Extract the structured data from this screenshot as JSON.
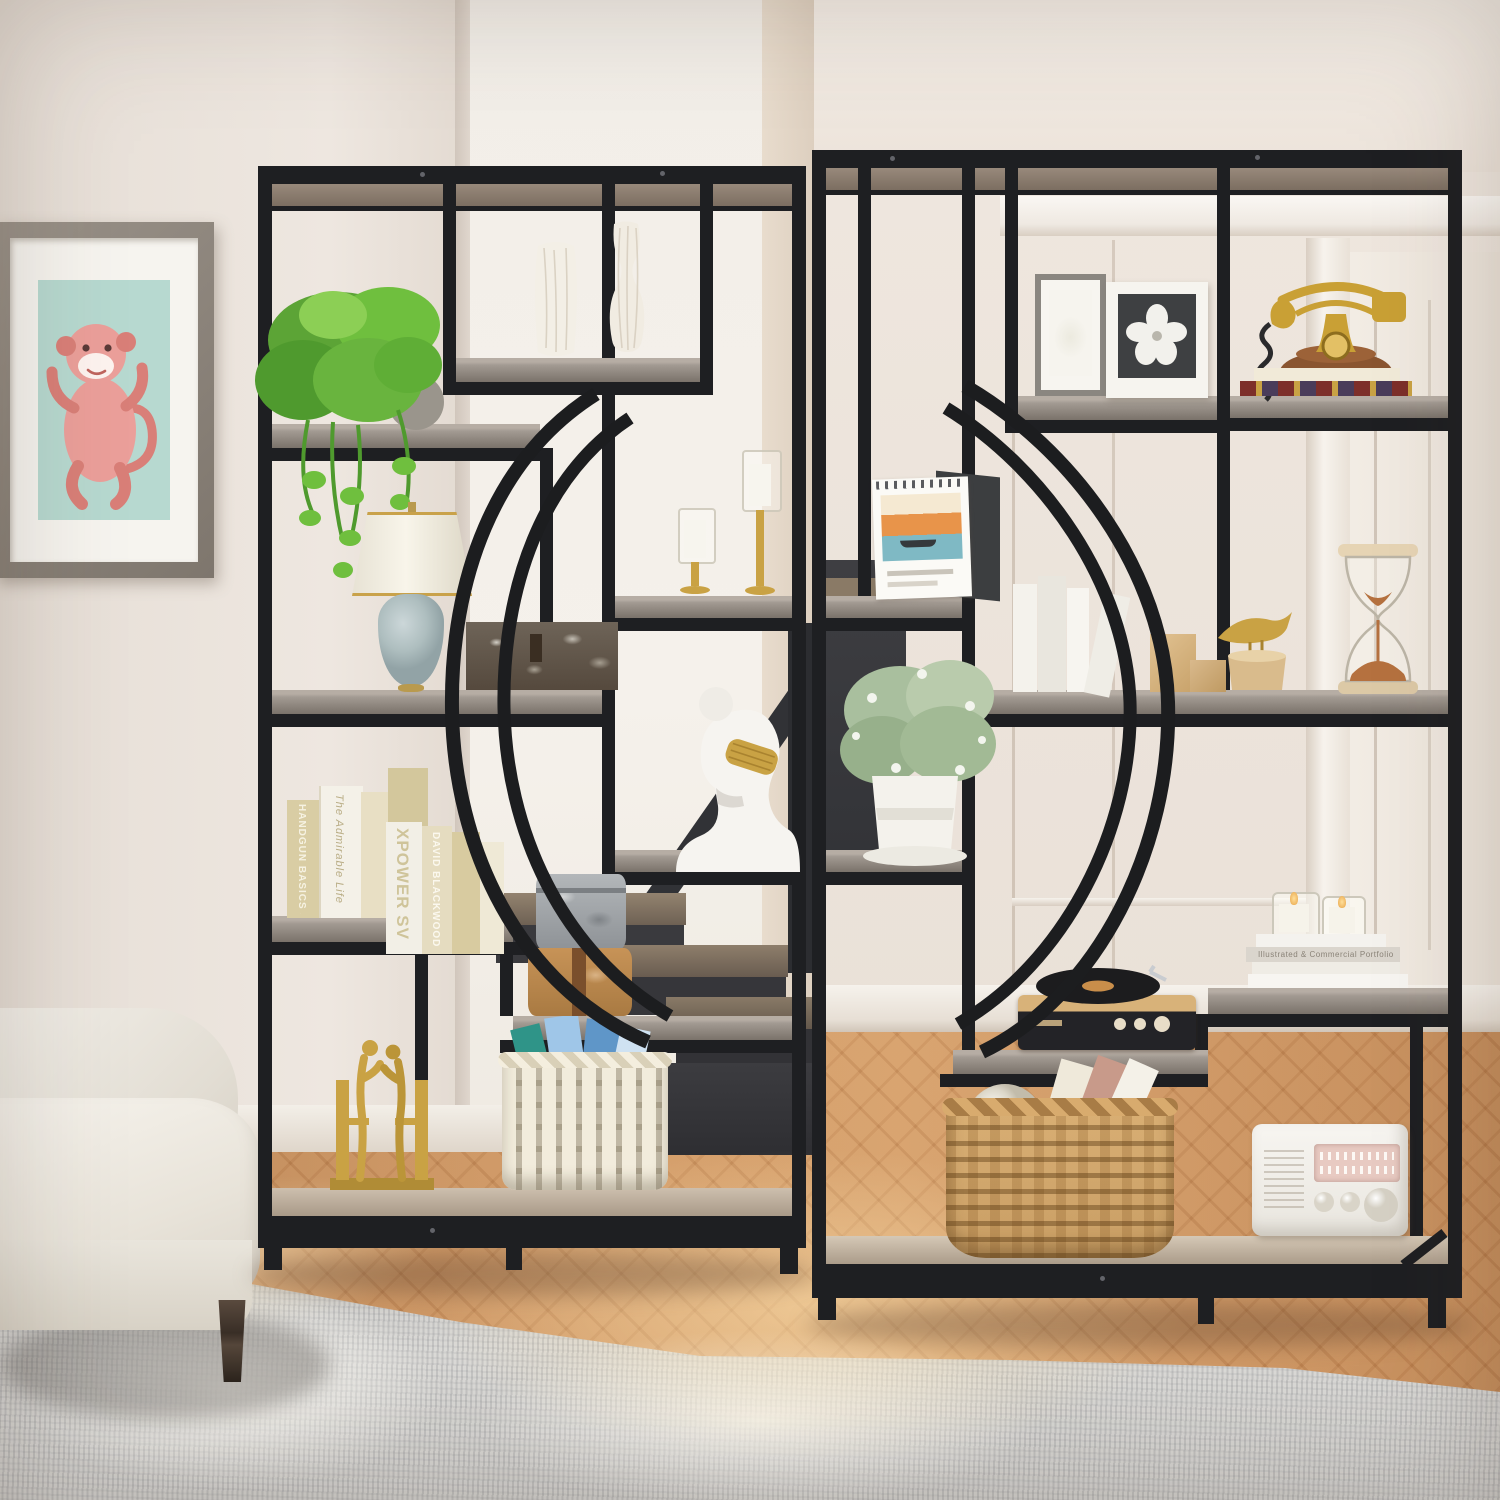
{
  "scene": {
    "type": "product lifestyle photograph",
    "subject": "Two black metal 9-tier etagere bookshelves with semicircular arc design placed side by side to form a circle, used as open room divider in a living room with staircase behind",
    "room_elements": [
      "beige walls",
      "white crown molding",
      "paneled wall and white door",
      "dark staircase with wood treads",
      "herringbone wood floor",
      "gray area rug",
      "cream fabric sofa",
      "framed pink monkey art"
    ]
  },
  "text": {
    "book_spines": {
      "handgun": "HANDGUN BASICS SAFETY & HANDLING",
      "admirable": "The Admirable Life",
      "xpower": "XPOWER SV",
      "blackwood": "DAVID BLACKWOOD",
      "portfolio": "Illustrated & Commercial Portfolio"
    }
  },
  "left_bookcase_items": [
    "two white striped vases",
    "trailing pothos plant",
    "table lamp with blue ceramic base",
    "rustic barnwood box",
    "two gold candle holders with glass hurricanes",
    "white bust sculpture with gold mesh mask",
    "beige book collection",
    "gold kissing couple figurine bookends",
    "white wicker basket with blue books",
    "stacked galvanized and rust metal hat boxes"
  ],
  "right_bookcase_items": [
    "two white flower picture frames",
    "antique gold telephone on books",
    "desk calendar with Venice artwork",
    "eucalyptus plant in white pot",
    "white books with gold bird figure and wood blocks",
    "hourglass with brown sand",
    "book stack with two votive candles",
    "vintage record player",
    "wicker basket with globe and books",
    "white retro radio"
  ],
  "palette": {
    "metal_frame": "#1e1f22",
    "shelf_wood": "#98908a",
    "wall": "#ece4dc",
    "alcove_wall": "#f3efe9",
    "floor_wood": "#c68a58",
    "rug": "#d8d7d4",
    "sofa": "#f0ede6",
    "gold_accent": "#c9a244",
    "art_background": "#b7d9d0",
    "art_monkey": "#eb9f9a",
    "lamp_base_blue": "#b7c6c9",
    "plant_green": "#69b43e",
    "eucalyptus_green": "#a9bf9e",
    "sand_brown": "#b5713f"
  }
}
